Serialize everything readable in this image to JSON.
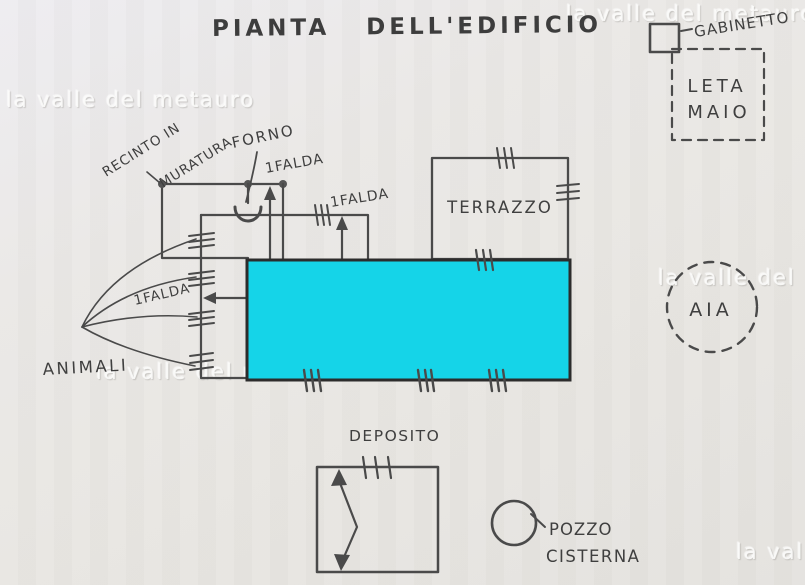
{
  "title": "PIANTA DELL'EDIFICIO",
  "watermark": "la valle del metauro",
  "colors": {
    "ink": "#4a4a4a",
    "building_fill": "#15d4e8",
    "paper": "#e8e6e2",
    "watermark_white": "#fdfdfb"
  },
  "legend": {
    "gabinetto": "GABINETTO",
    "letamaio_line1": "LETA",
    "letamaio_line2": "MAIO"
  },
  "labels": {
    "recinto_line1": "RECINTO IN",
    "recinto_line2": "MURATURA",
    "forno": "FORNO",
    "falda_top": "1FALDA",
    "falda_mid": "1FALDA",
    "falda_left": "1FALDA",
    "terrazzo": "TERRAZZO",
    "aia": "AIA",
    "animali": "ANIMALI",
    "deposito": "DEPOSITO",
    "pozzo_line1": "POZZO",
    "pozzo_line2": "CISTERNA"
  }
}
